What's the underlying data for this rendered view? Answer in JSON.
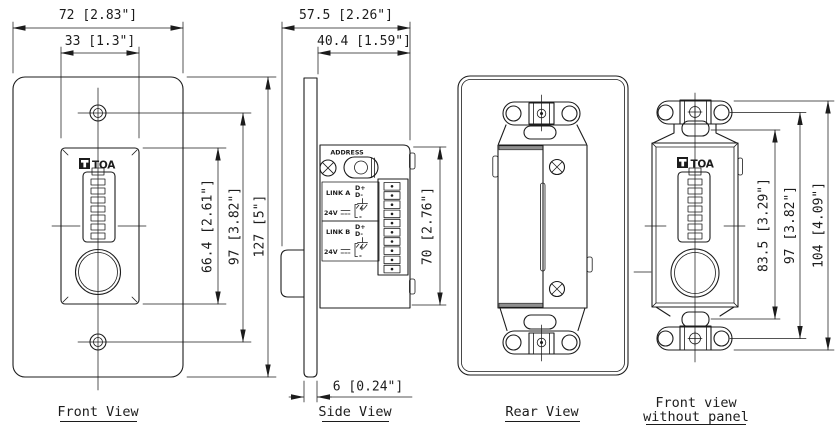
{
  "views": {
    "front": {
      "label": "Front View",
      "logo_text": "TOA",
      "dim_width_outer": "72 [2.83\"]",
      "dim_width_inner": "33 [1.3\"]",
      "dim_insert_height": "66.4 [2.61\"]",
      "dim_screw_spacing": "97 [3.82\"]",
      "dim_overall_height": "127 [5\"]"
    },
    "side": {
      "label": "Side View",
      "dim_depth_overall": "57.5 [2.26\"]",
      "dim_depth_body": "40.4 [1.59\"]",
      "dim_body_height": "70 [2.76\"]",
      "dim_panel_thickness": "6 [0.24\"]",
      "address_label": "ADDRESS",
      "link_a_label": "LINK A",
      "link_b_label": "LINK B",
      "d_plus_label": "D+",
      "d_minus_label": "D-",
      "power_label": "24V",
      "plus_label": "+",
      "minus_label": "-"
    },
    "rear": {
      "label": "Rear View"
    },
    "front_without_panel": {
      "label_line1": "Front view",
      "label_line2": "without panel",
      "logo_text": "TOA",
      "dim_body_height": "83.5 [3.29\"]",
      "dim_screw_spacing": "97 [3.82\"]",
      "dim_overall_height": "104 [4.09\"]"
    }
  },
  "colors": {
    "line": "#1c1c1c",
    "background": "#ffffff"
  }
}
